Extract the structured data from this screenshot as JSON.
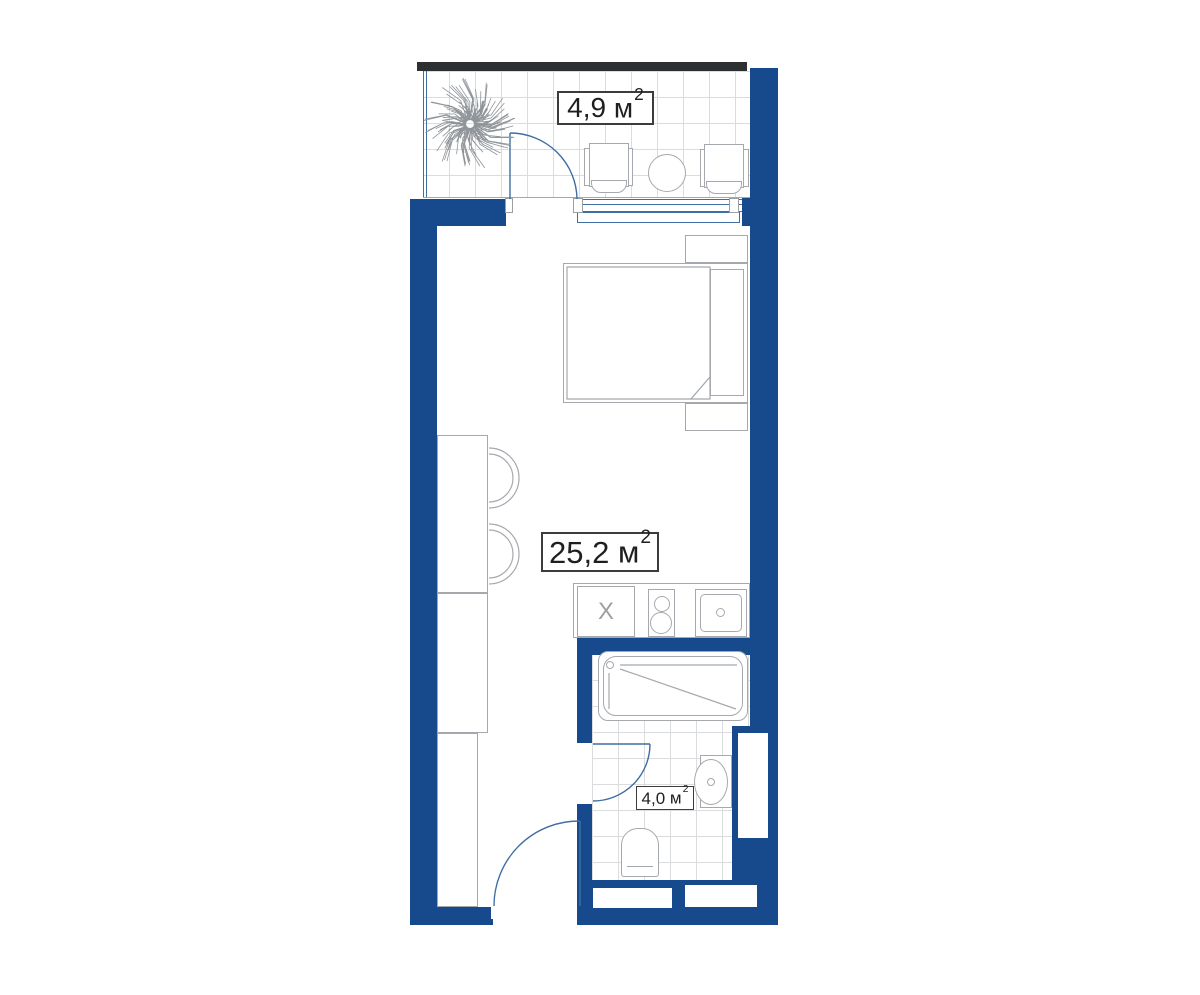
{
  "labels": {
    "balcony": {
      "value": "4,9",
      "unit": "м",
      "sup": "2"
    },
    "living": {
      "value": "25,2",
      "unit": "м",
      "sup": "2"
    },
    "bathroom": {
      "value": "4,0",
      "unit": "м",
      "sup": "2"
    }
  },
  "kitchen": {
    "appliance_mark": "X"
  },
  "palette": {
    "wall": "#174A8C",
    "door_line": "#3F6EA3",
    "furniture_line": "#A5A9AD",
    "grid_line": "#DADCDE",
    "top_strip": "#2D2F31",
    "label_text": "#1F1F1F",
    "label_border": "#3C3C3C"
  }
}
